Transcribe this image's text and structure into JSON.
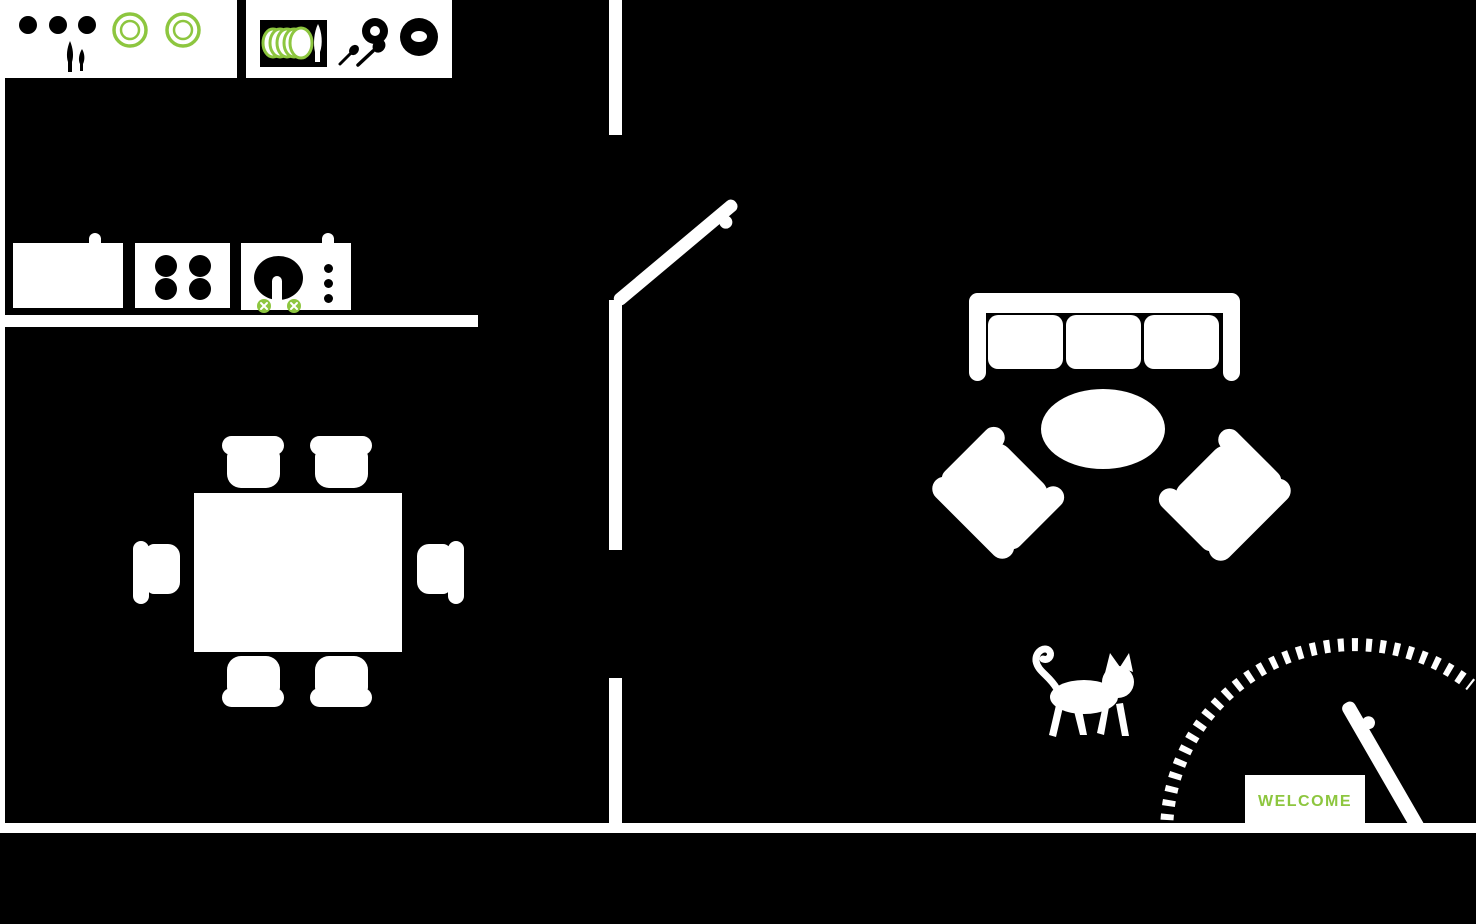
{
  "canvas": {
    "width": 1476,
    "height": 924
  },
  "palette": {
    "floor": "#000000",
    "walls_fixtures": "#ffffff",
    "accent_green": "#8dc63f"
  },
  "welcome_mat": {
    "label": "WELCOME",
    "text_color": "#8dc63f"
  },
  "rooms": {
    "left_zone_objects": [
      "kitchen-counter-a",
      "jar-dots-icon",
      "knife-fork-icon",
      "plate-ring-icon",
      "kitchen-counter-b",
      "dish-rack-icon",
      "stacked-plates-icon",
      "knife-icon",
      "cup-ring-icon",
      "spoons-icon",
      "bowl-donut-icon",
      "refrigerator",
      "stove-cooktop",
      "burner-icon",
      "sink-unit",
      "basin-icon",
      "faucet-icon",
      "tap-cross-icon",
      "counter-edge",
      "dining-table",
      "dining-chair"
    ],
    "right_zone_objects": [
      "sofa-three-seat",
      "sofa-cushion",
      "coffee-table-oval",
      "armchair-left",
      "armchair-right",
      "cat-icon",
      "interior-door",
      "front-door",
      "door-knob-icon",
      "door-swing-arc",
      "welcome-mat"
    ]
  },
  "structure": {
    "walls": [
      "left-wall",
      "bottom-wall",
      "middle-wall-top",
      "middle-wall-mid",
      "middle-wall-low"
    ],
    "openings": [
      "interior-doorway",
      "hall-passage",
      "front-entry"
    ]
  }
}
